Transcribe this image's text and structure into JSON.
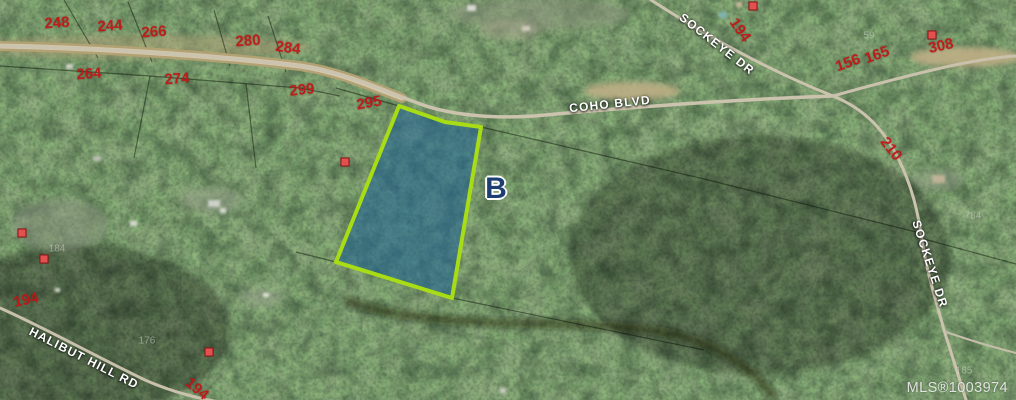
{
  "map": {
    "type": "aerial-parcel-map",
    "parcel_label": "B",
    "watermark": "MLS®1003974",
    "colors": {
      "parcel_fill": "#1f6395",
      "parcel_outline": "#a8dc14",
      "lot_number_red": "#c41414",
      "road_label": "#ffffff",
      "parcel_marker_navy": "#1e3e73",
      "house_marker_red": "#e2514f"
    },
    "road_labels": [
      {
        "text": "COHO BLVD",
        "x": 610,
        "y": 104,
        "rot": -6
      },
      {
        "text": "SOCKEYE DR",
        "x": 717,
        "y": 44,
        "rot": 38
      },
      {
        "text": "SOCKEYE DR",
        "x": 930,
        "y": 264,
        "rot": 72
      },
      {
        "text": "HALIBUT HILL RD",
        "x": 84,
        "y": 358,
        "rot": 27
      }
    ],
    "lot_numbers_red": [
      {
        "text": "248",
        "x": 57,
        "y": 23,
        "rot": -4
      },
      {
        "text": "244",
        "x": 110,
        "y": 26,
        "rot": -4
      },
      {
        "text": "266",
        "x": 154,
        "y": 32,
        "rot": -4
      },
      {
        "text": "280",
        "x": 248,
        "y": 41,
        "rot": -4
      },
      {
        "text": "284",
        "x": 288,
        "y": 48,
        "rot": 8
      },
      {
        "text": "264",
        "x": 89,
        "y": 74,
        "rot": -4
      },
      {
        "text": "274",
        "x": 177,
        "y": 79,
        "rot": -4
      },
      {
        "text": "299",
        "x": 302,
        "y": 90,
        "rot": -6
      },
      {
        "text": "295",
        "x": 369,
        "y": 103,
        "rot": -10
      },
      {
        "text": "194",
        "x": 740,
        "y": 30,
        "rot": 55
      },
      {
        "text": "156",
        "x": 848,
        "y": 63,
        "rot": -20
      },
      {
        "text": "165",
        "x": 877,
        "y": 55,
        "rot": -20
      },
      {
        "text": "308",
        "x": 941,
        "y": 46,
        "rot": -12
      },
      {
        "text": "210",
        "x": 891,
        "y": 149,
        "rot": 52
      },
      {
        "text": "194",
        "x": 26,
        "y": 300,
        "rot": -12
      },
      {
        "text": "194",
        "x": 197,
        "y": 389,
        "rot": 40
      }
    ],
    "lot_numbers_faint": [
      {
        "text": "59",
        "x": 869,
        "y": 36,
        "rot": 0
      },
      {
        "text": "184",
        "x": 57,
        "y": 249,
        "rot": 0
      },
      {
        "text": "176",
        "x": 147,
        "y": 341,
        "rot": 0
      },
      {
        "text": "784",
        "x": 973,
        "y": 216,
        "rot": 0
      },
      {
        "text": "185",
        "x": 964,
        "y": 371,
        "rot": 0
      }
    ],
    "house_markers": [
      {
        "x": 345,
        "y": 162
      },
      {
        "x": 753,
        "y": 6
      },
      {
        "x": 932,
        "y": 35
      },
      {
        "x": 22,
        "y": 233
      },
      {
        "x": 44,
        "y": 259
      },
      {
        "x": 209,
        "y": 352
      }
    ]
  }
}
